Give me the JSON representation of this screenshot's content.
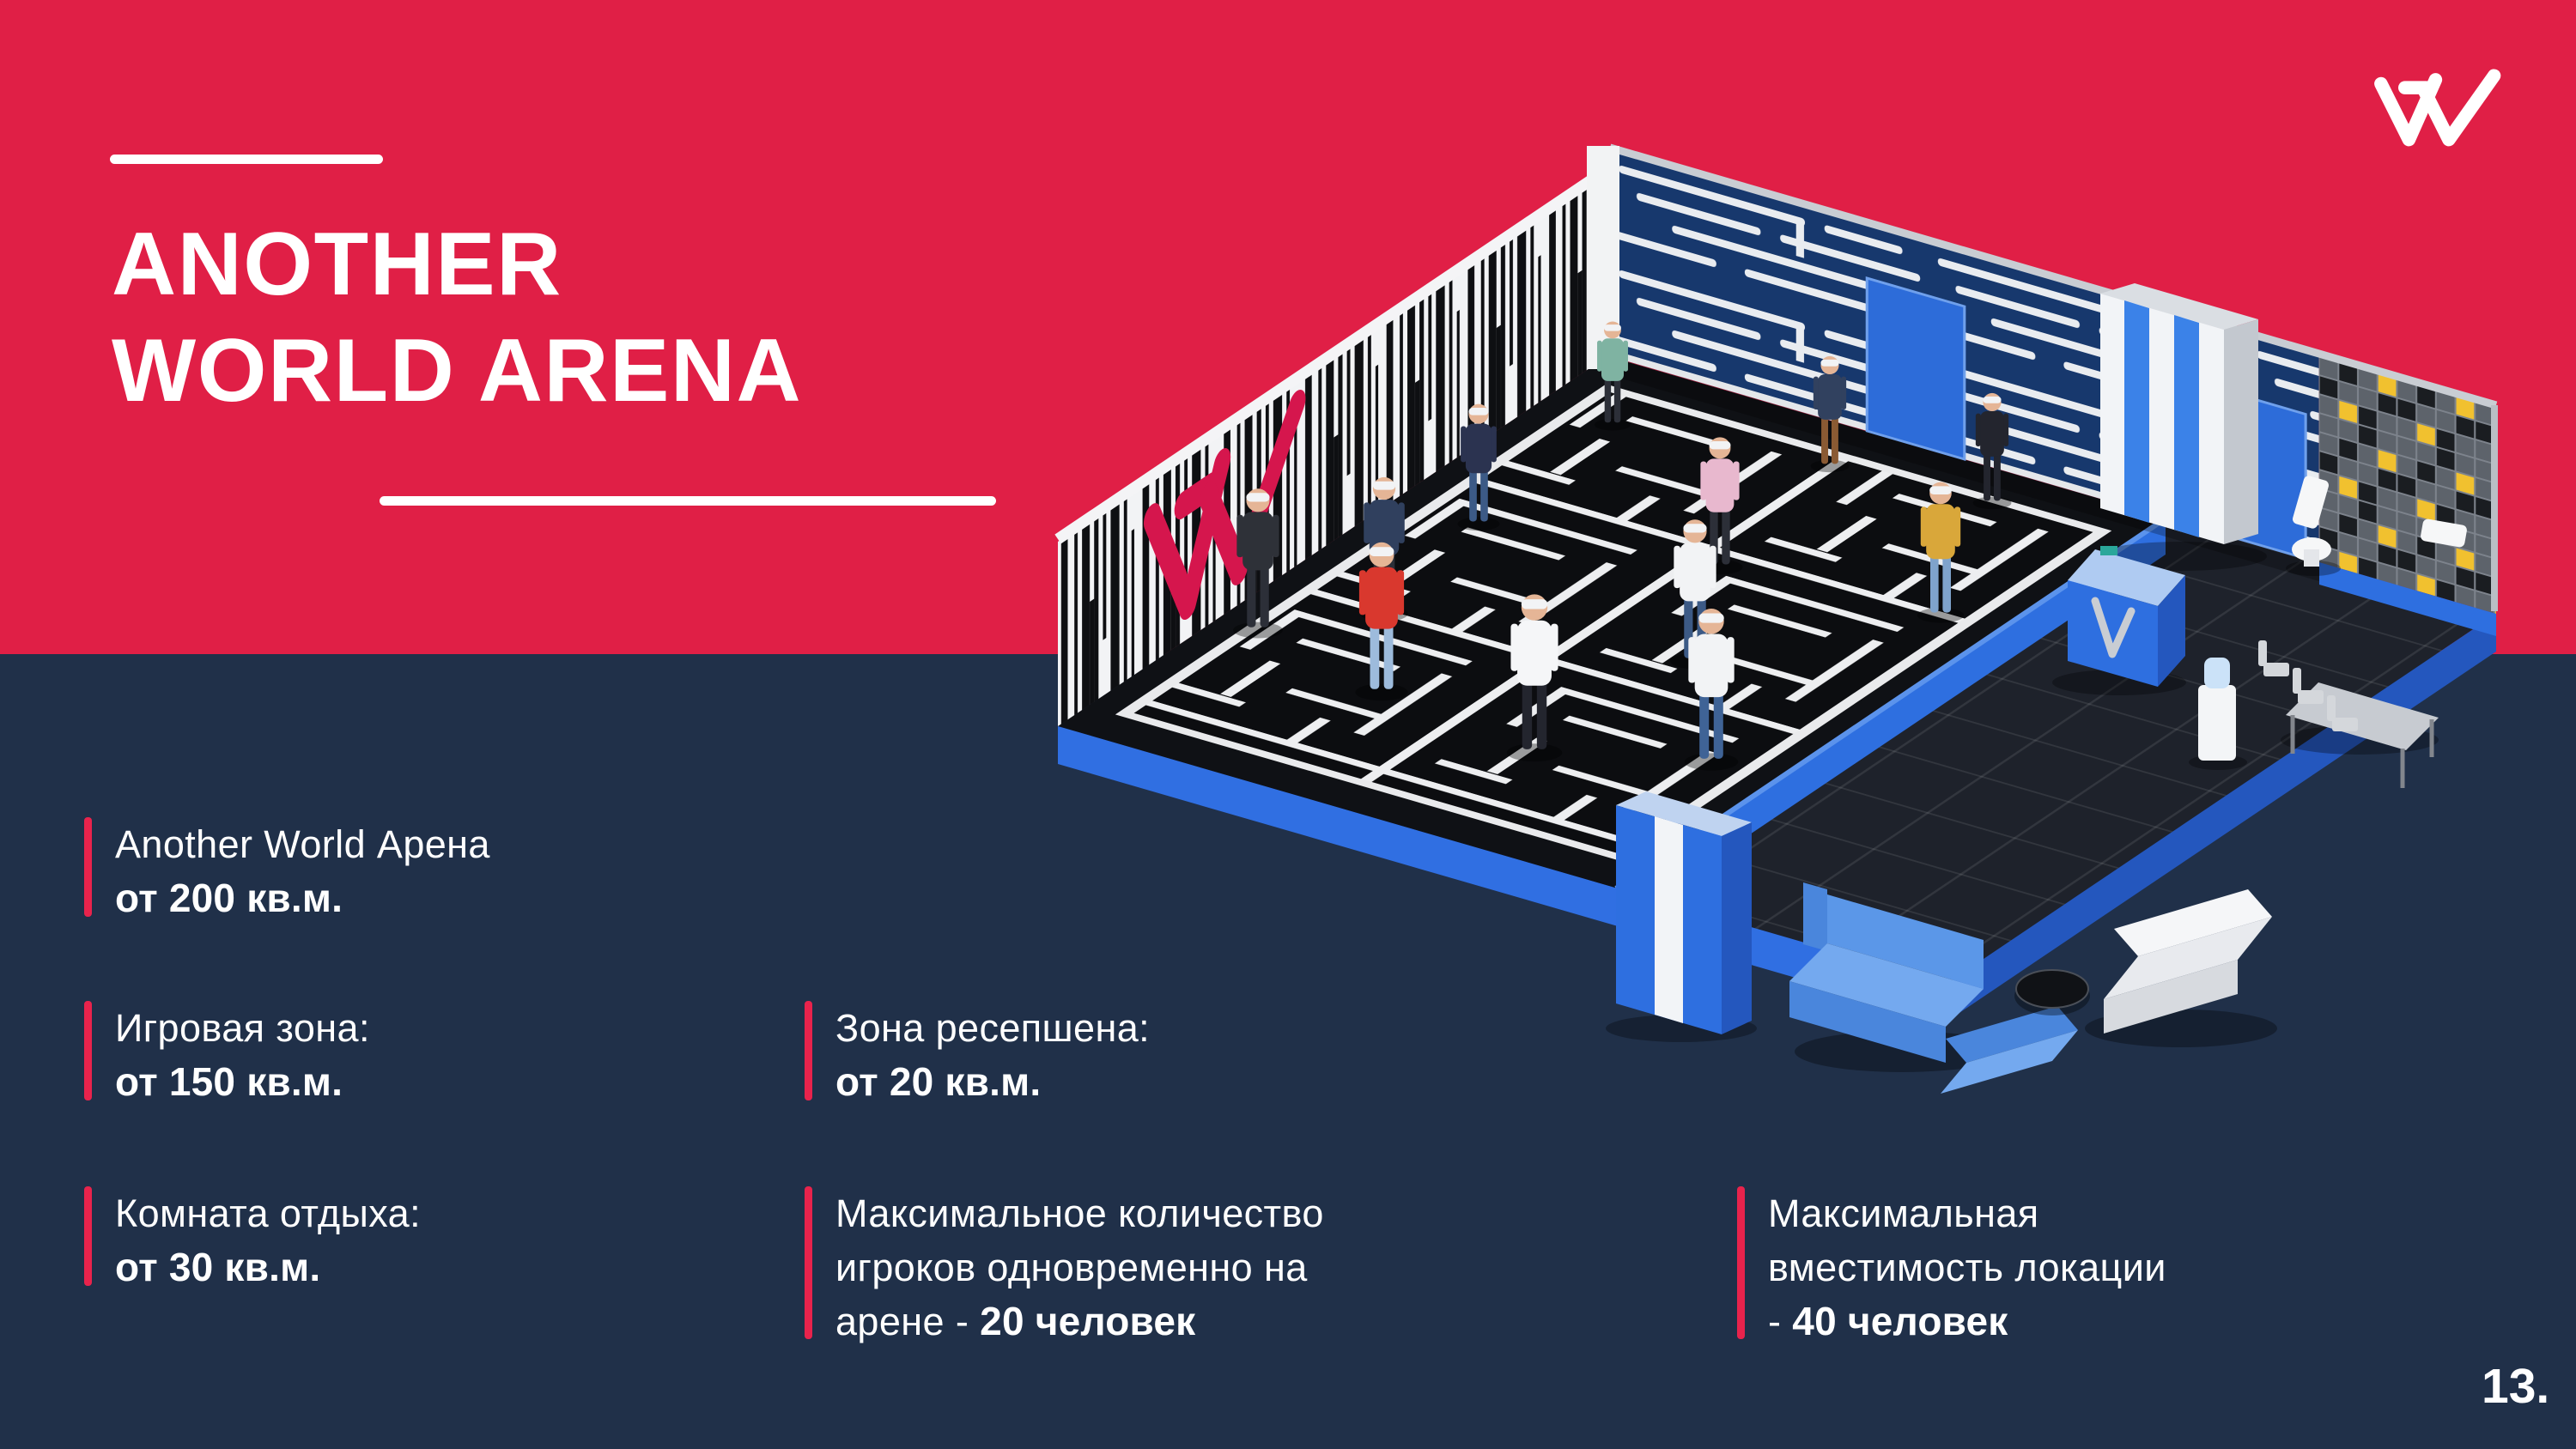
{
  "header": {
    "title_line1": "ANOTHER",
    "title_line2": "WORLD ARENA"
  },
  "logo": {
    "name": "another-world-logomark"
  },
  "illustration": {
    "name": "arena-isometric-3d-render"
  },
  "stats": [
    {
      "lines": [
        {
          "pre": "Another World Арена"
        },
        {
          "bold": "от 200 кв.м."
        }
      ]
    },
    {
      "lines": [
        {
          "pre": "Игровая зона:"
        },
        {
          "bold": "от 150 кв.м."
        }
      ]
    },
    {
      "lines": [
        {
          "pre": "Комната отдыха:"
        },
        {
          "bold": "от 30 кв.м."
        }
      ]
    },
    {
      "lines": [
        {
          "pre": "Зона ресепшена:"
        },
        {
          "bold": "от 20 кв.м."
        }
      ]
    },
    {
      "lines": [
        {
          "pre": "Максимальное количество"
        },
        {
          "pre": "игроков одновременно на"
        },
        {
          "pre": "арене - ",
          "bold": "20 человек"
        }
      ]
    },
    {
      "lines": [
        {
          "pre": "Максимальная"
        },
        {
          "pre": "вместимость локации"
        },
        {
          "pre": "- ",
          "bold": "40 человек"
        }
      ]
    }
  ],
  "page_number": "13.",
  "colors": {
    "background_red": "#E01F46",
    "background_navy": "#203049",
    "accent_bar_red": "#E8234C",
    "arena_wall_navy": "#17386D",
    "arena_blue": "#2E6FE0",
    "mosaic_yellow": "#F1C12F",
    "text_white": "#FFFFFF"
  }
}
